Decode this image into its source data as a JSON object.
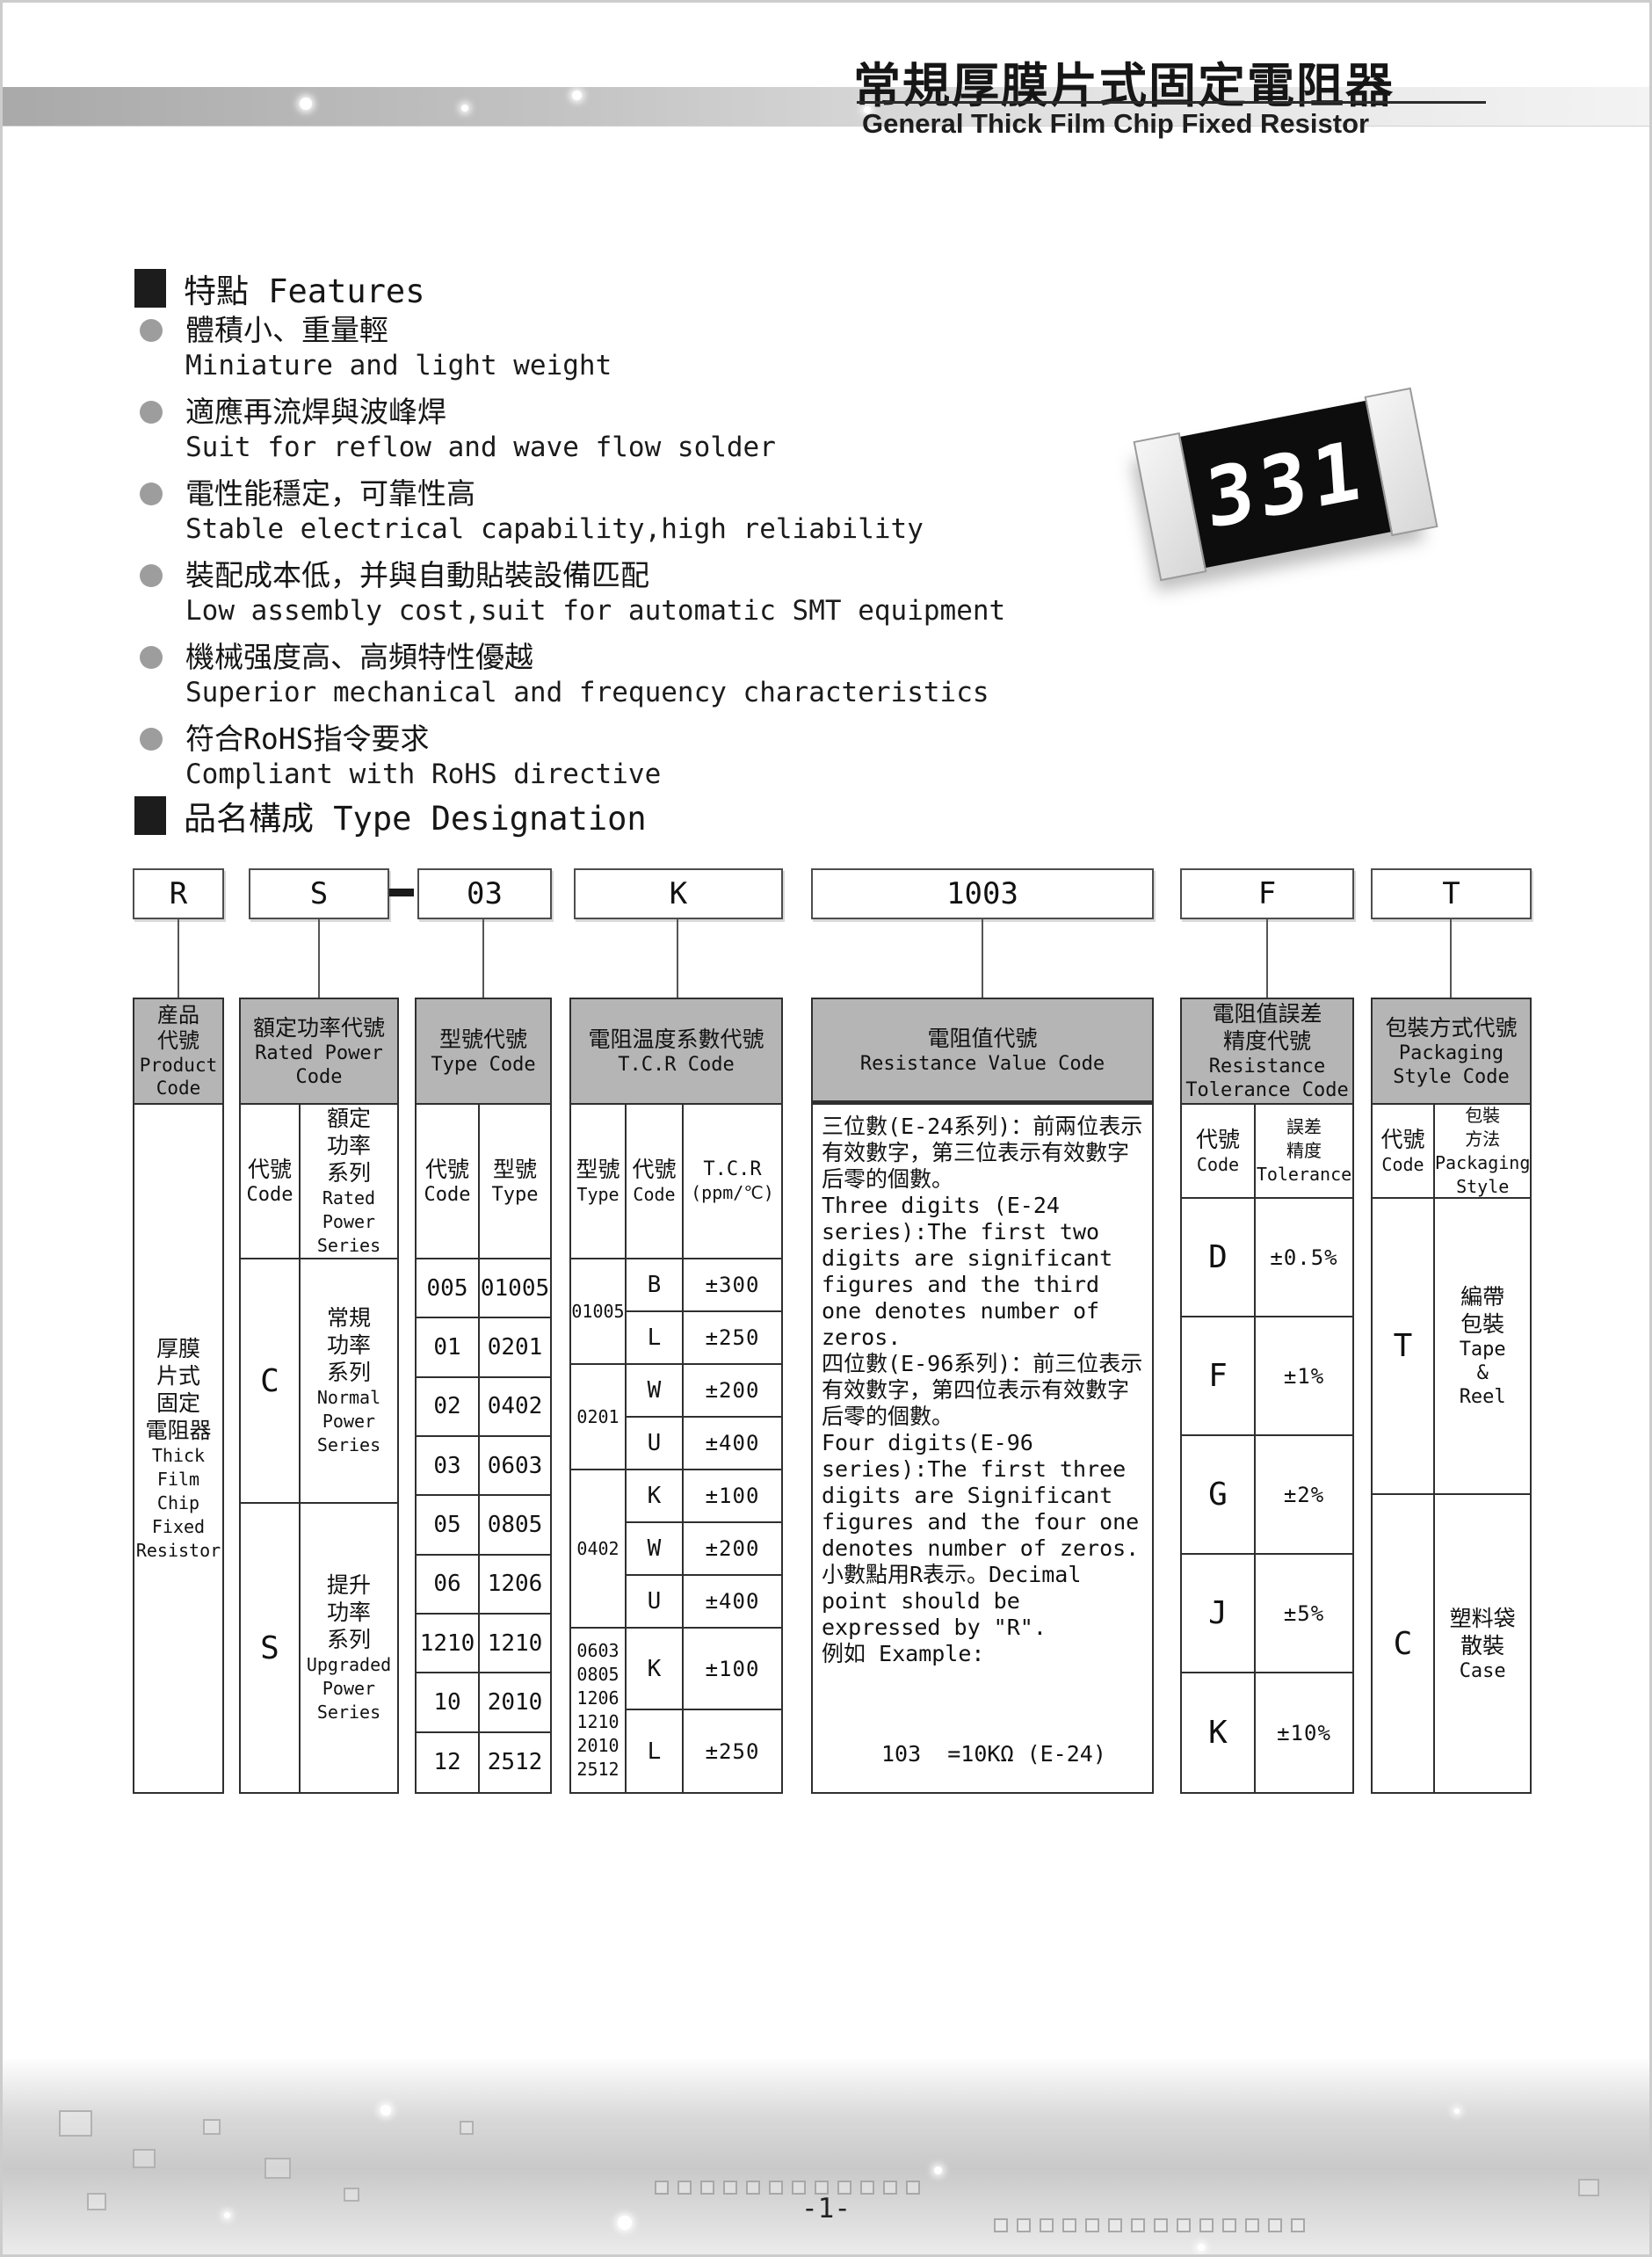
{
  "page": {
    "number": "-1-"
  },
  "header": {
    "title_zh": "常規厚膜片式固定電阻器",
    "title_en": "General Thick Film Chip Fixed Resistor"
  },
  "features": {
    "heading": "特點 Features",
    "items": [
      {
        "zh": "體積小、重量輕",
        "en": "Miniature and light weight"
      },
      {
        "zh": "適應再流焊與波峰焊",
        "en": "Suit for reflow and wave flow solder"
      },
      {
        "zh": "電性能穩定，可靠性高",
        "en": "Stable electrical capability,high reliability"
      },
      {
        "zh": "裝配成本低，并與自動貼裝設備匹配",
        "en": "Low assembly cost,suit for automatic SMT equipment"
      },
      {
        "zh": "機械强度高、高頻特性優越",
        "en": "Superior mechanical and frequency characteristics"
      },
      {
        "zh": "符合RoHS指令要求",
        "en": "Compliant with RoHS directive"
      }
    ]
  },
  "resistor": {
    "marking": "331"
  },
  "designation": {
    "heading": "品名構成  Type Designation",
    "codes": {
      "product": "R",
      "power": "S",
      "type": "03",
      "tcr": "K",
      "value": "1003",
      "tolerance": "F",
      "packaging": "T"
    }
  },
  "table": {
    "product": {
      "header": [
        "産品",
        "代號",
        "Product",
        "Code"
      ],
      "body_zh": [
        "厚膜",
        "片式",
        "固定",
        "電阻器"
      ],
      "body_en": [
        "Thick",
        "Film",
        "Chip",
        "Fixed",
        "Resistor"
      ]
    },
    "power": {
      "header": [
        "額定功率代號",
        "Rated Power",
        "Code"
      ],
      "sub_code": [
        "代號",
        "Code"
      ],
      "sub_series": [
        "額定",
        "功率",
        "系列",
        "Rated",
        "Power",
        "Series"
      ],
      "rows": [
        {
          "code": "C",
          "zh": [
            "常規",
            "功率",
            "系列"
          ],
          "en": [
            "Normal",
            "Power",
            "Series"
          ]
        },
        {
          "code": "S",
          "zh": [
            "提升",
            "功率",
            "系列"
          ],
          "en": [
            "Upgraded",
            "Power",
            "Series"
          ]
        }
      ]
    },
    "type": {
      "header": [
        "型號代號",
        "Type Code"
      ],
      "sub": [
        "代號",
        "Code",
        "型號",
        "Type"
      ],
      "rows": [
        [
          "005",
          "01005"
        ],
        [
          "01",
          "0201"
        ],
        [
          "02",
          "0402"
        ],
        [
          "03",
          "0603"
        ],
        [
          "05",
          "0805"
        ],
        [
          "06",
          "1206"
        ],
        [
          "1210",
          "1210"
        ],
        [
          "10",
          "2010"
        ],
        [
          "12",
          "2512"
        ]
      ]
    },
    "tcr": {
      "header": [
        "電阻温度系數代號",
        "T.C.R Code"
      ],
      "sub": [
        "型號",
        "Type",
        "代號",
        "Code",
        "T.C.R",
        "(ppm/℃)"
      ],
      "groups": [
        {
          "type": [
            "01005"
          ],
          "rows": [
            [
              "B",
              "±300"
            ],
            [
              "L",
              "±250"
            ]
          ]
        },
        {
          "type": [
            "0201"
          ],
          "rows": [
            [
              "W",
              "±200"
            ],
            [
              "U",
              "±400"
            ]
          ]
        },
        {
          "type": [
            "0402"
          ],
          "rows": [
            [
              "K",
              "±100"
            ],
            [
              "W",
              "±200"
            ],
            [
              "U",
              "±400"
            ]
          ]
        },
        {
          "type": [
            "0603",
            "0805",
            "1206",
            "1210",
            "2010",
            "2512"
          ],
          "rows": [
            [
              "K",
              "±100"
            ],
            [
              "L",
              "±250"
            ]
          ]
        }
      ]
    },
    "value": {
      "header": [
        "電阻值代號",
        "Resistance Value Code"
      ],
      "paragraphs": [
        "三位數(E-24系列)：前兩位表示有效數字，第三位表示有效數字后零的個數。",
        "Three digits (E-24 series):The first two digits are significant figures and the third one denotes number of zeros.",
        "四位數(E-96系列)：前三位表示有效數字，第四位表示有效數字后零的個數。",
        "Four digits(E-96 series):The first three digits are Significant figures and the four one denotes number of zeros.",
        "小數點用R表示。Decimal point should be expressed by \"R\".",
        "例如 Example:"
      ],
      "examples": [
        "103  =10KΩ (E-24)",
        "1003=100KΩ(E-96)",
        "1R0 =1.0Ω  (E-24)"
      ]
    },
    "tolerance": {
      "header": [
        "電阻值誤差",
        "精度代號",
        "Resistance",
        "Tolerance Code"
      ],
      "sub": [
        "代號",
        "Code",
        "誤差",
        "精度",
        "Tolerance"
      ],
      "rows": [
        [
          "D",
          "±0.5%"
        ],
        [
          "F",
          "±1%"
        ],
        [
          "G",
          "±2%"
        ],
        [
          "J",
          "±5%"
        ],
        [
          "K",
          "±10%"
        ]
      ]
    },
    "packaging": {
      "header": [
        "包裝方式代號",
        "Packaging",
        "Style Code"
      ],
      "sub": [
        "代號",
        "Code",
        "包裝",
        "方法",
        "Packaging",
        "Style"
      ],
      "rows": [
        {
          "code": "T",
          "zh": [
            "編帶",
            "包裝"
          ],
          "en": [
            "Tape",
            "&",
            "Reel"
          ]
        },
        {
          "code": "C",
          "zh": [
            "塑料袋",
            "散裝"
          ],
          "en": [
            "Case"
          ]
        }
      ]
    }
  }
}
